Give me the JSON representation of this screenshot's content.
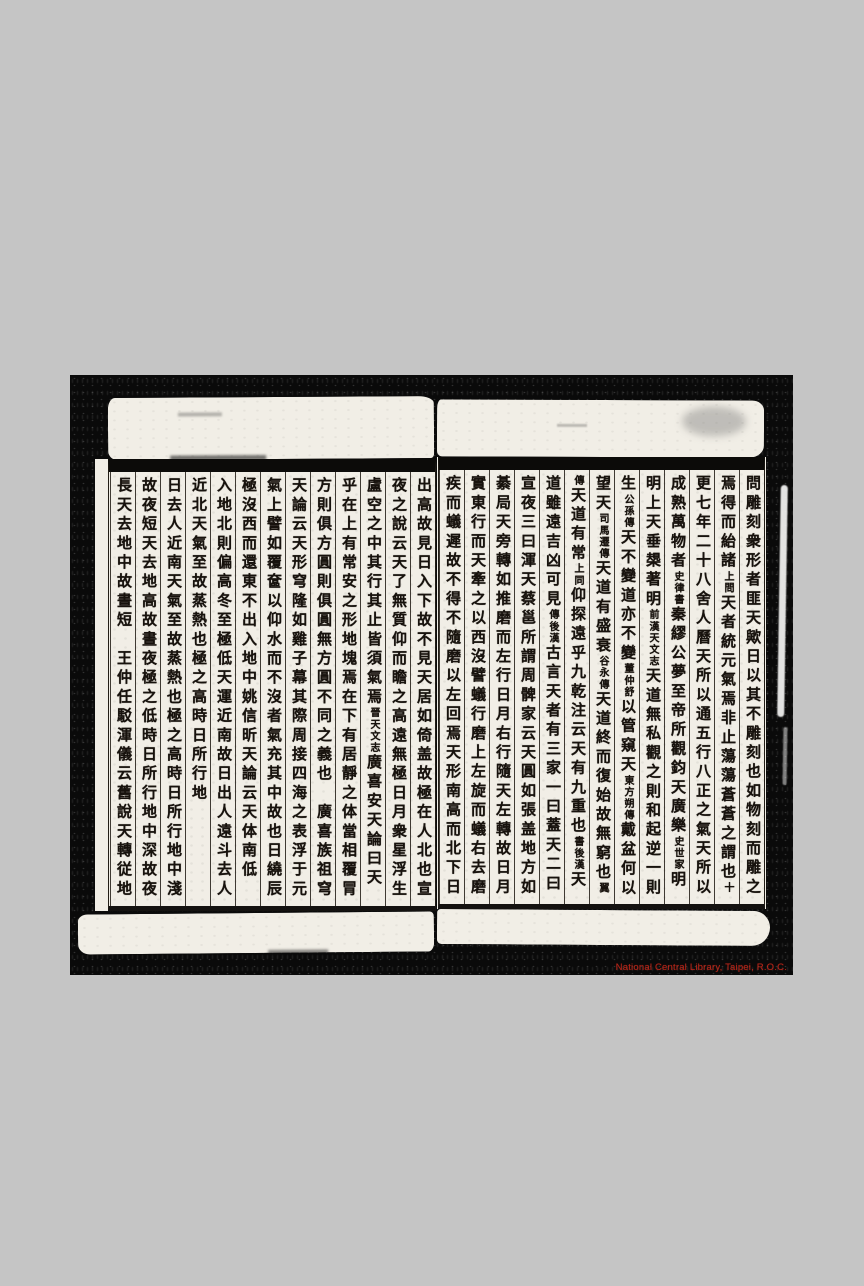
{
  "colors": {
    "backdrop": "#c5c5c5",
    "scan-black": "#0a0a0a",
    "paper": "#f1eee6",
    "ink": "#17120d",
    "watermark-red": "#c5281a"
  },
  "watermark": {
    "text": "National Central Library, Taipei, R.O.C."
  },
  "right_page": {
    "columns": [
      {
        "segments": [
          {
            "text": "問雕刻衆形者匪天歟日以其不雕刻也如物刻而雕之",
            "small": false
          }
        ]
      },
      {
        "segments": [
          {
            "text": "焉得而紿諸",
            "small": false
          },
          {
            "text": "上問",
            "small": true
          },
          {
            "text": "天者統元氣焉非止蕩蕩蒼蒼之謂也",
            "small": false
          },
          {
            "text": "十交",
            "small": true
          }
        ]
      },
      {
        "segments": [
          {
            "text": "更七年二十八舍人曆天所以通五行八正之氣天所以",
            "small": false
          }
        ]
      },
      {
        "segments": [
          {
            "text": "成熟萬物者",
            "small": false
          },
          {
            "text": "史律書",
            "small": true
          },
          {
            "text": "秦繆公夢至帝所觀鈞天廣樂",
            "small": false
          },
          {
            "text": "史世家",
            "small": true
          },
          {
            "text": "明",
            "small": false
          }
        ]
      },
      {
        "segments": [
          {
            "text": "明上天垂槼著明",
            "small": false
          },
          {
            "text": "前漢天文志",
            "small": true
          },
          {
            "text": "天道無私觀之則和起逆一則害",
            "small": false
          }
        ]
      },
      {
        "segments": [
          {
            "text": "生",
            "small": false
          },
          {
            "text": "公孫傳",
            "small": true
          },
          {
            "text": "天不變道亦不變",
            "small": false
          },
          {
            "text": "董仲舒",
            "small": true
          },
          {
            "text": "以管窺天",
            "small": false
          },
          {
            "text": "東方朔傳",
            "small": true
          },
          {
            "text": "戴盆何以",
            "small": false
          }
        ]
      },
      {
        "segments": [
          {
            "text": "望天",
            "small": false
          },
          {
            "text": "司馬遷傳",
            "small": true
          },
          {
            "text": "天道有盛衰",
            "small": false
          },
          {
            "text": "谷永傳",
            "small": true
          },
          {
            "text": "天道終而復始故無窮也",
            "small": false
          },
          {
            "text": "翼",
            "small": true
          }
        ]
      },
      {
        "segments": [
          {
            "text": "傳",
            "small": true
          },
          {
            "text": "天道有常",
            "small": false
          },
          {
            "text": "上同",
            "small": true
          },
          {
            "text": "仰探遠乎九乾注云天有九重也",
            "small": false
          },
          {
            "text": "書後漢",
            "small": true
          },
          {
            "text": "天",
            "small": false
          }
        ]
      },
      {
        "segments": [
          {
            "text": "道雖遠吉凶可見",
            "small": false
          },
          {
            "text": "傳後漢",
            "small": true
          },
          {
            "text": "古言天者有三家一曰蓋天二曰",
            "small": false
          }
        ]
      },
      {
        "segments": [
          {
            "text": "宣夜三曰渾天蔡邕所謂周髀家云天圓如張盖地方如",
            "small": false
          }
        ]
      },
      {
        "segments": [
          {
            "text": "綦局天旁轉如推磨而左行日月右行隨天左轉故日月",
            "small": false
          }
        ]
      },
      {
        "segments": [
          {
            "text": "實東行而天牽之以西沒譬蟻行磨上左旋而蟻右去磨",
            "small": false
          }
        ]
      },
      {
        "segments": [
          {
            "text": "疾而蟻遲故不得不隨磨以左回焉天形南高而北下日",
            "small": false
          }
        ]
      }
    ]
  },
  "left_page": {
    "columns": [
      {
        "segments": [
          {
            "text": "出高故見日入下故不見天居如倚盖故極在人北也宣",
            "small": false
          }
        ]
      },
      {
        "segments": [
          {
            "text": "夜之說云天了無質仰而瞻之高遠無極日月衆星浮生",
            "small": false
          }
        ]
      },
      {
        "segments": [
          {
            "text": "盧空之中其行其止皆須氣焉",
            "small": false
          },
          {
            "text": "晉天文志",
            "small": true
          },
          {
            "text": "廣喜安天論曰天確",
            "small": false
          }
        ]
      },
      {
        "segments": [
          {
            "text": "乎在上有常安之形地塊焉在下有居靜之体當相覆冐",
            "small": false
          }
        ]
      },
      {
        "segments": [
          {
            "text": "方則俱方圓則俱圓無方圓不同之義也　廣喜族祖穹",
            "small": false
          }
        ]
      },
      {
        "segments": [
          {
            "text": "天論云天形穹隆如雞子幕其際周接四海之表浮于元",
            "small": false
          }
        ]
      },
      {
        "segments": [
          {
            "text": "氣上譬如覆奩以仰水而不沒者氣充其中故也日繞辰",
            "small": false
          }
        ]
      },
      {
        "segments": [
          {
            "text": "極沒西而還東不出入地中姚信昕天論云天体南低",
            "small": false
          }
        ]
      },
      {
        "segments": [
          {
            "text": "入地北則偏高冬至極低天運近南故日出人遠斗去人",
            "small": false
          }
        ]
      },
      {
        "segments": [
          {
            "text": "近北天氣至故蒸熱也極之高時日所行地",
            "small": false
          }
        ]
      },
      {
        "segments": [
          {
            "text": "日去人近南天氣至故蒸熱也極之高時日所行地中淺",
            "small": false
          }
        ]
      },
      {
        "segments": [
          {
            "text": "故夜短天去地高故晝夜極之低時日所行地中深故夜",
            "small": false
          }
        ]
      },
      {
        "segments": [
          {
            "text": "長天去地中故晝短　王仲任駁渾儀云舊說天轉従地",
            "small": false
          }
        ]
      }
    ]
  }
}
